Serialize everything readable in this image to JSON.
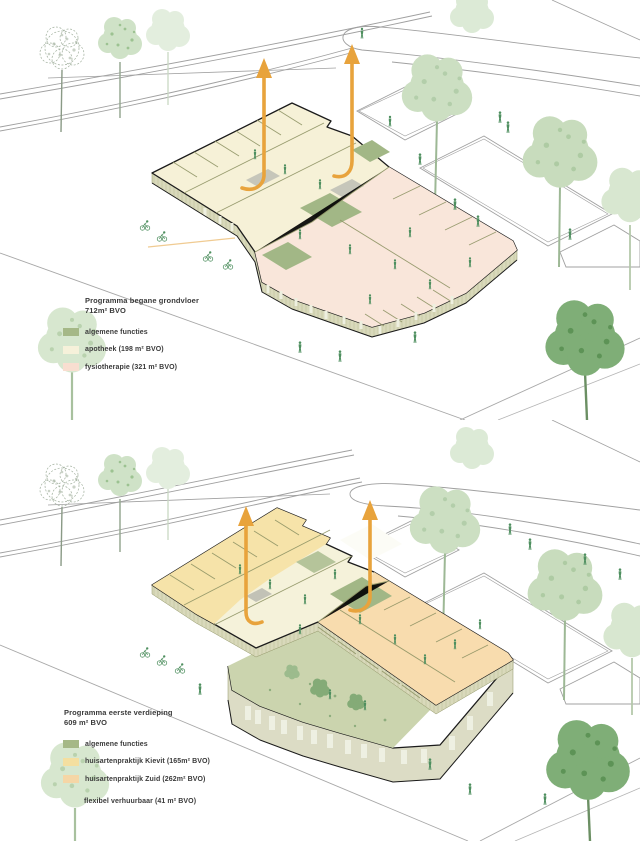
{
  "document": {
    "kind": "architectural axonometric program diagram, two stacked floor views"
  },
  "panels": {
    "ground_floor": {
      "title_line1": "Programma begane grondvloer",
      "title_line2": "712m² BVO",
      "legend": [
        {
          "label": "algemene functies",
          "color": "#a5b887"
        },
        {
          "label": "apotheek (198 m² BVO)",
          "color": "#f6f1da"
        },
        {
          "label": "fysiotherapie (321 m² BVO)",
          "color": "#f8ded0"
        }
      ]
    },
    "first_floor": {
      "title_line1": "Programma eerste verdieping",
      "title_line2": "609 m² BVO",
      "legend": [
        {
          "label": "algemene functies",
          "color": "#a5b887"
        },
        {
          "label": "huisartenpraktijk Kievit (165m² BVO)",
          "color": "#f4dfa0"
        },
        {
          "label": "huisartenpraktijk Zuid (262m² BVO)",
          "color": "#f5d6a6"
        }
      ],
      "note": "flexibel verhuurbaar (41 m² BVO)"
    }
  },
  "colors": {
    "arrow_orange": "#e8a33c",
    "floor_cream": "#f6f1d7",
    "floor_salmon": "#f9e6da",
    "floor_yellow": "#f6e3a9",
    "floor_orange": "#f8dcae",
    "green_function": "#a2b786",
    "wall_olive": "#d9d9bb",
    "outline_black": "#1b1b1b",
    "road_gray": "#a0a0a0",
    "tree_pale": "#ccdfc2",
    "tree_dark": "#7fae77",
    "people_green": "#4e8f5f"
  }
}
